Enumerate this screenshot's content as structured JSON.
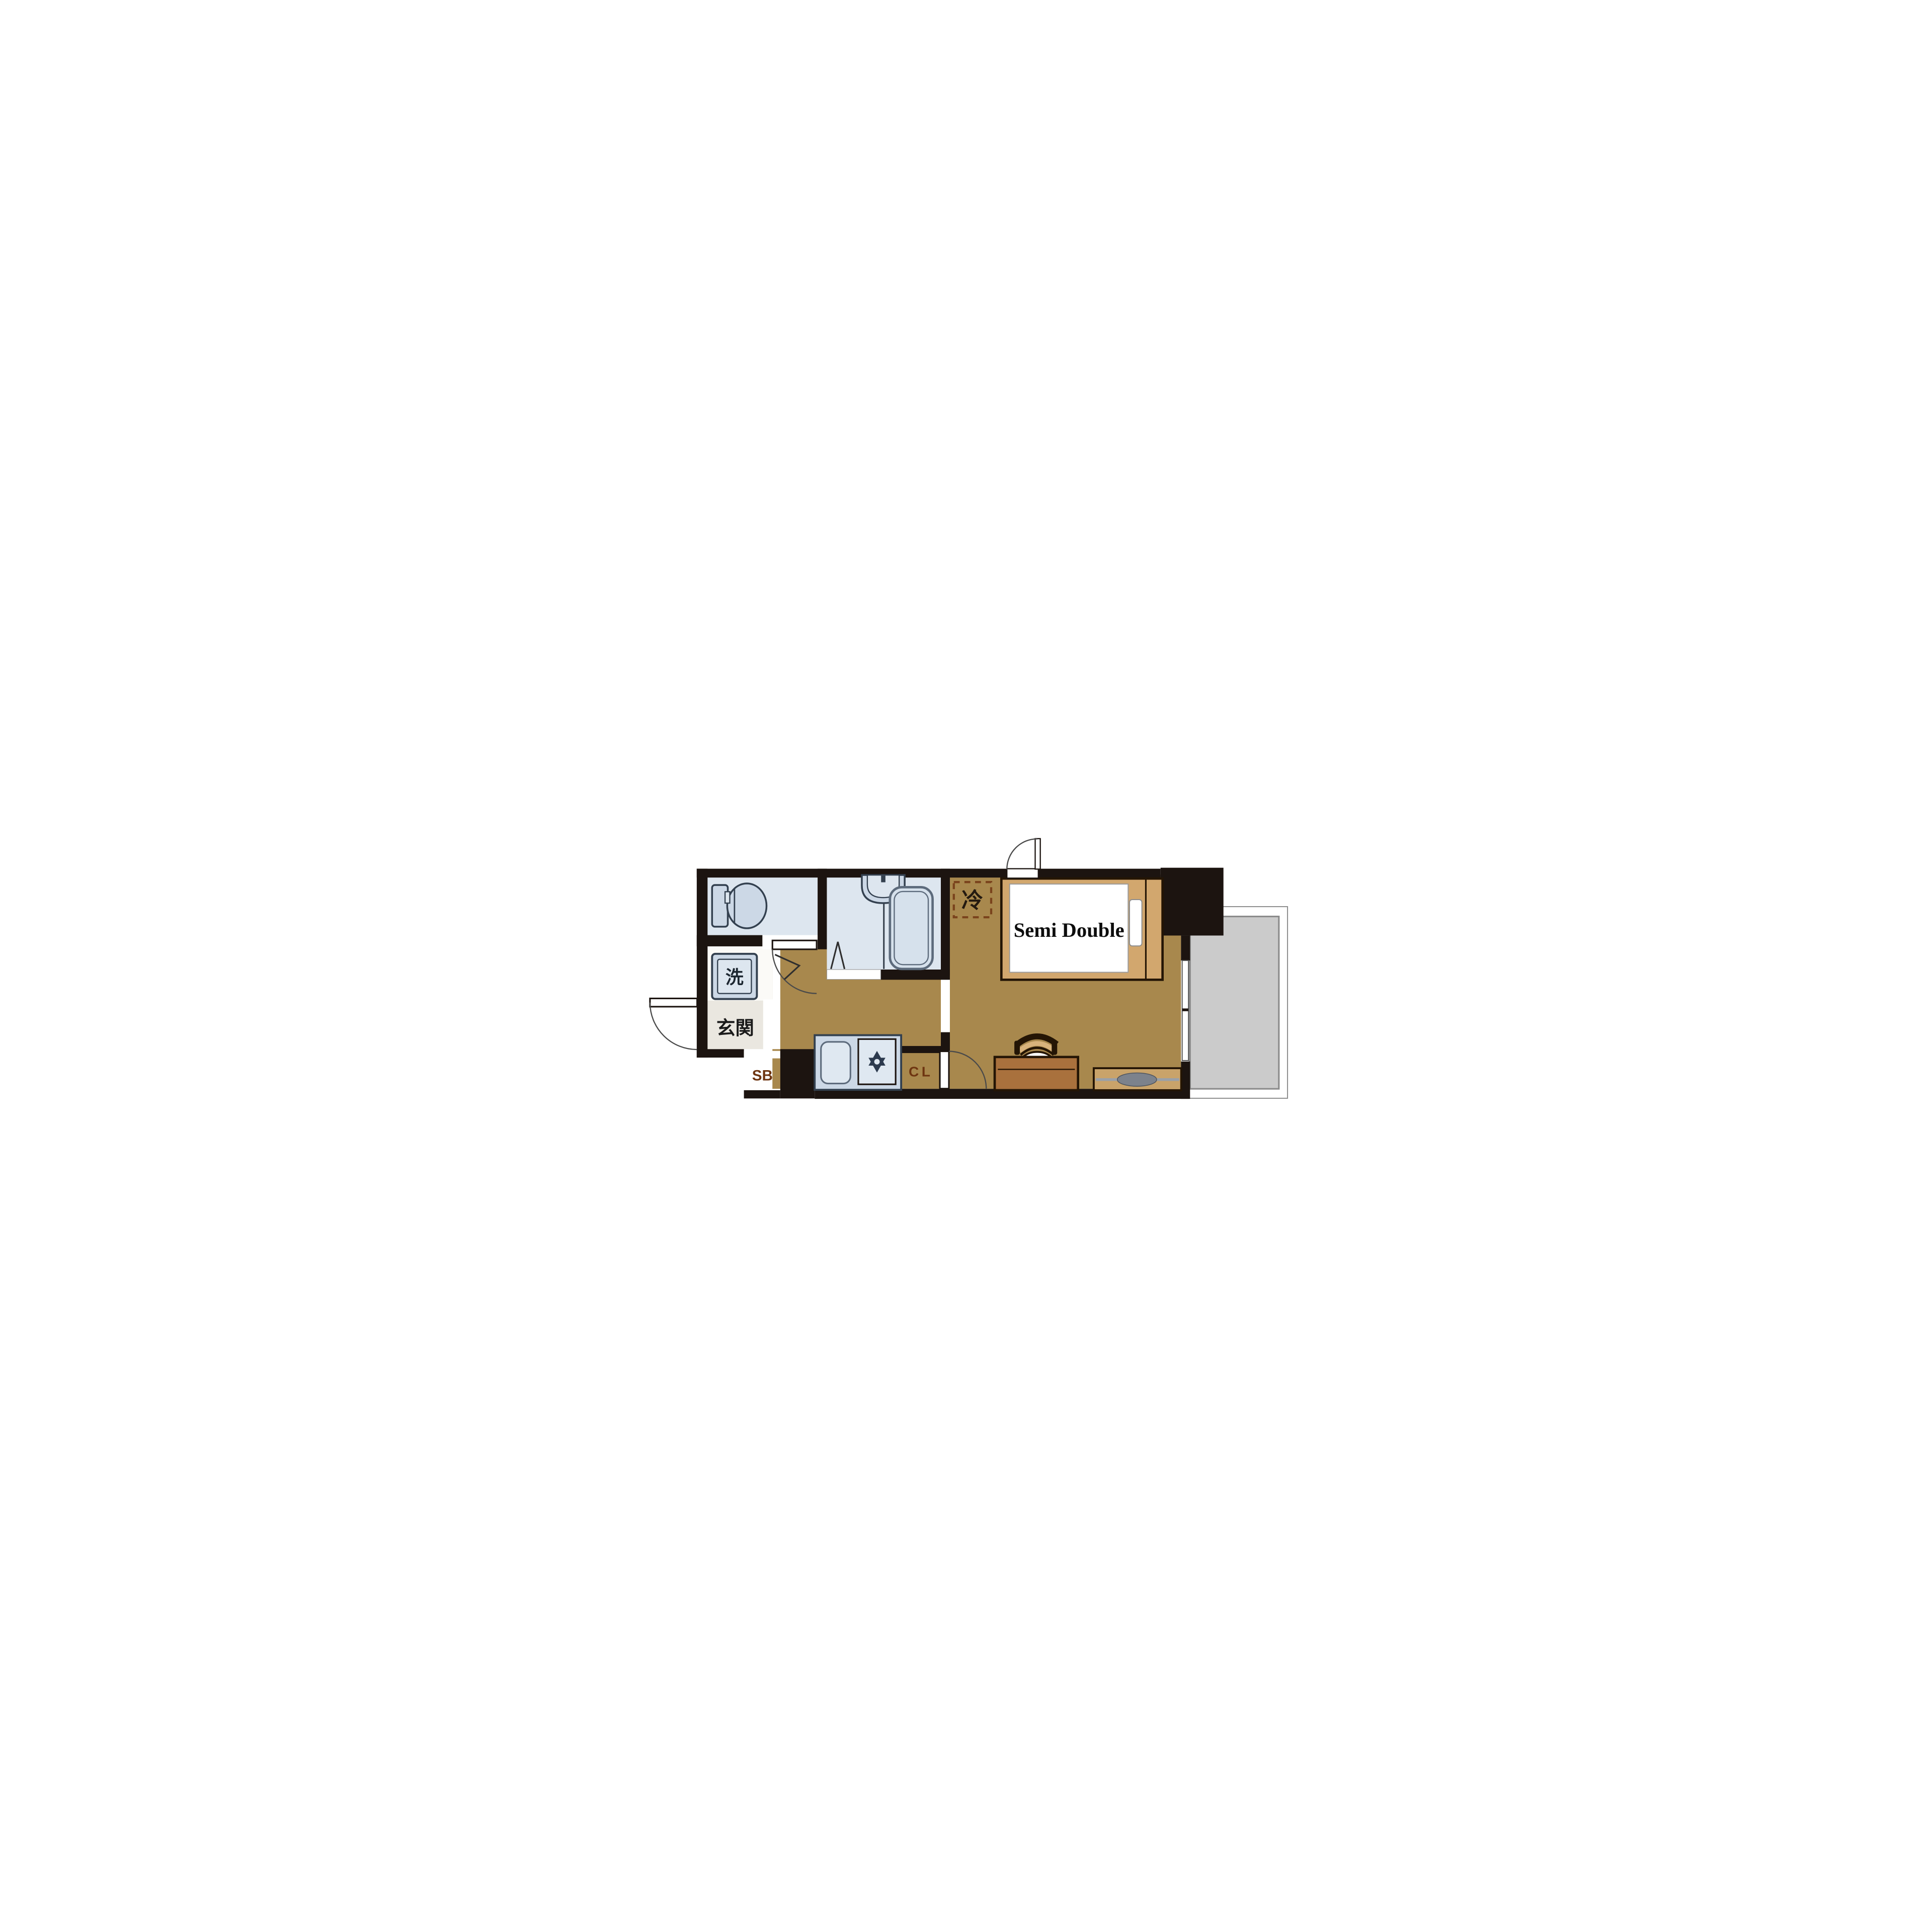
{
  "labels": {
    "bed_size": "Semi Double",
    "entrance_jp": "玄関",
    "washing_machine_jp": "洗",
    "refrigerator_jp": "冷",
    "shoe_box": "SB",
    "closet": "CL"
  },
  "colors": {
    "wall": "#1c1410",
    "floor": "#a8884d",
    "wet_floor": "#dde6ef",
    "fixture": "#ccd8e6",
    "fixture_border": "#33404f",
    "genkan_floor": "#eae7e0",
    "washroom_floor": "#fbfaf7",
    "balcony_deck": "#cbcbcb",
    "balcony_border": "#8b8b8b",
    "cabinet": "#a2592b",
    "cabinet_text": "#6e3511",
    "bed_frame": "#d2a76e",
    "furniture_outline": "#241505",
    "desk": "#a9713d",
    "tv_board": "#c9a36a",
    "tv_gray": "#7c828c",
    "chair_stripe_1": "#d8b37c",
    "chair_stripe_2": "#e7cda1",
    "stove_icon": "#2c3a4e",
    "tub_border": "#5d6b7c",
    "fridge_dash": "#7a431c",
    "arc": "#4a4a4a",
    "text_dark": "#1a1a1a"
  }
}
